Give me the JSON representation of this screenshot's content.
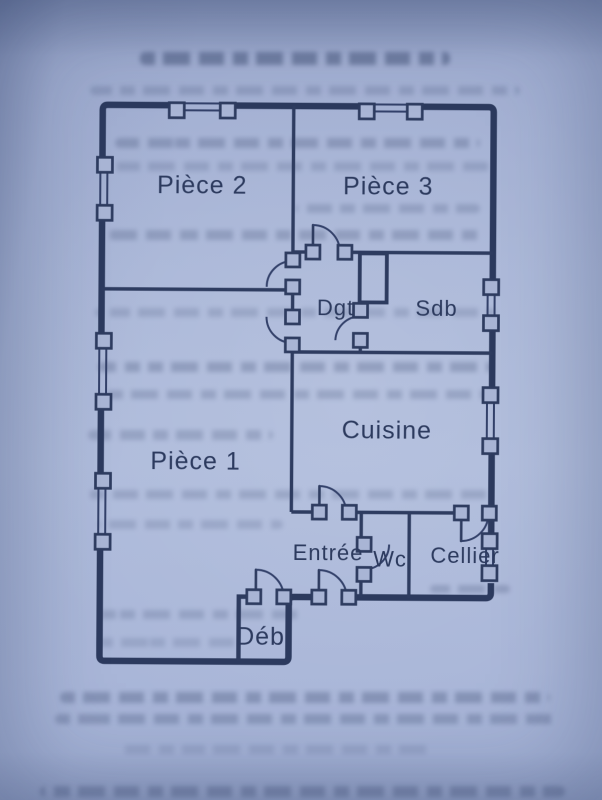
{
  "floor_plan": {
    "rooms": [
      {
        "id": "piece-2",
        "label": "Pièce 2"
      },
      {
        "id": "piece-3",
        "label": "Pièce 3"
      },
      {
        "id": "dgt",
        "label": "Dgt"
      },
      {
        "id": "sdb",
        "label": "Sdb"
      },
      {
        "id": "cuisine",
        "label": "Cuisine"
      },
      {
        "id": "piece-1",
        "label": "Pièce 1"
      },
      {
        "id": "entree",
        "label": "Entrée"
      },
      {
        "id": "wc",
        "label": "Wc"
      },
      {
        "id": "cellier",
        "label": "Cellier"
      },
      {
        "id": "deb",
        "label": "Déb"
      }
    ],
    "symbols": {
      "window_count": 8,
      "door_swing_count": 9,
      "duct_box_count": 1
    },
    "colors": {
      "ink": "#2e3b5c",
      "paper": "#a9b6d6"
    }
  }
}
